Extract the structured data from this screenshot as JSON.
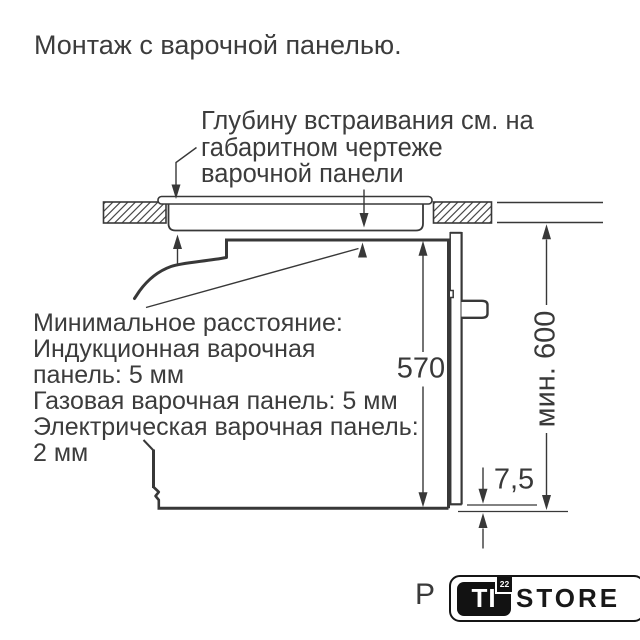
{
  "page": {
    "title": "Монтаж с варочной панелью."
  },
  "annotations": {
    "depth_note": {
      "lines": [
        "Глубину встраивания см. на",
        "габаритном чертеже",
        "варочной панели"
      ]
    },
    "min_distance": {
      "lines": [
        "Минимальное расстояние:",
        "Индукционная варочная",
        "панель: 5 мм",
        "Газовая варочная панель: 5 мм",
        "Электрическая варочная панель:",
        "2 мм"
      ]
    }
  },
  "dimensions": {
    "oven_front_height_mm": "570",
    "niche_height_mm": "мин. 600",
    "bottom_gap_mm": "7,5"
  },
  "footer": {
    "page_marker": "P",
    "logo": {
      "ti": "TI",
      "badge": "22",
      "store": "STORE"
    }
  },
  "colors": {
    "line": "#383838",
    "text": "#3c3c3c",
    "logo_black": "#121212",
    "background": "#ffffff"
  }
}
